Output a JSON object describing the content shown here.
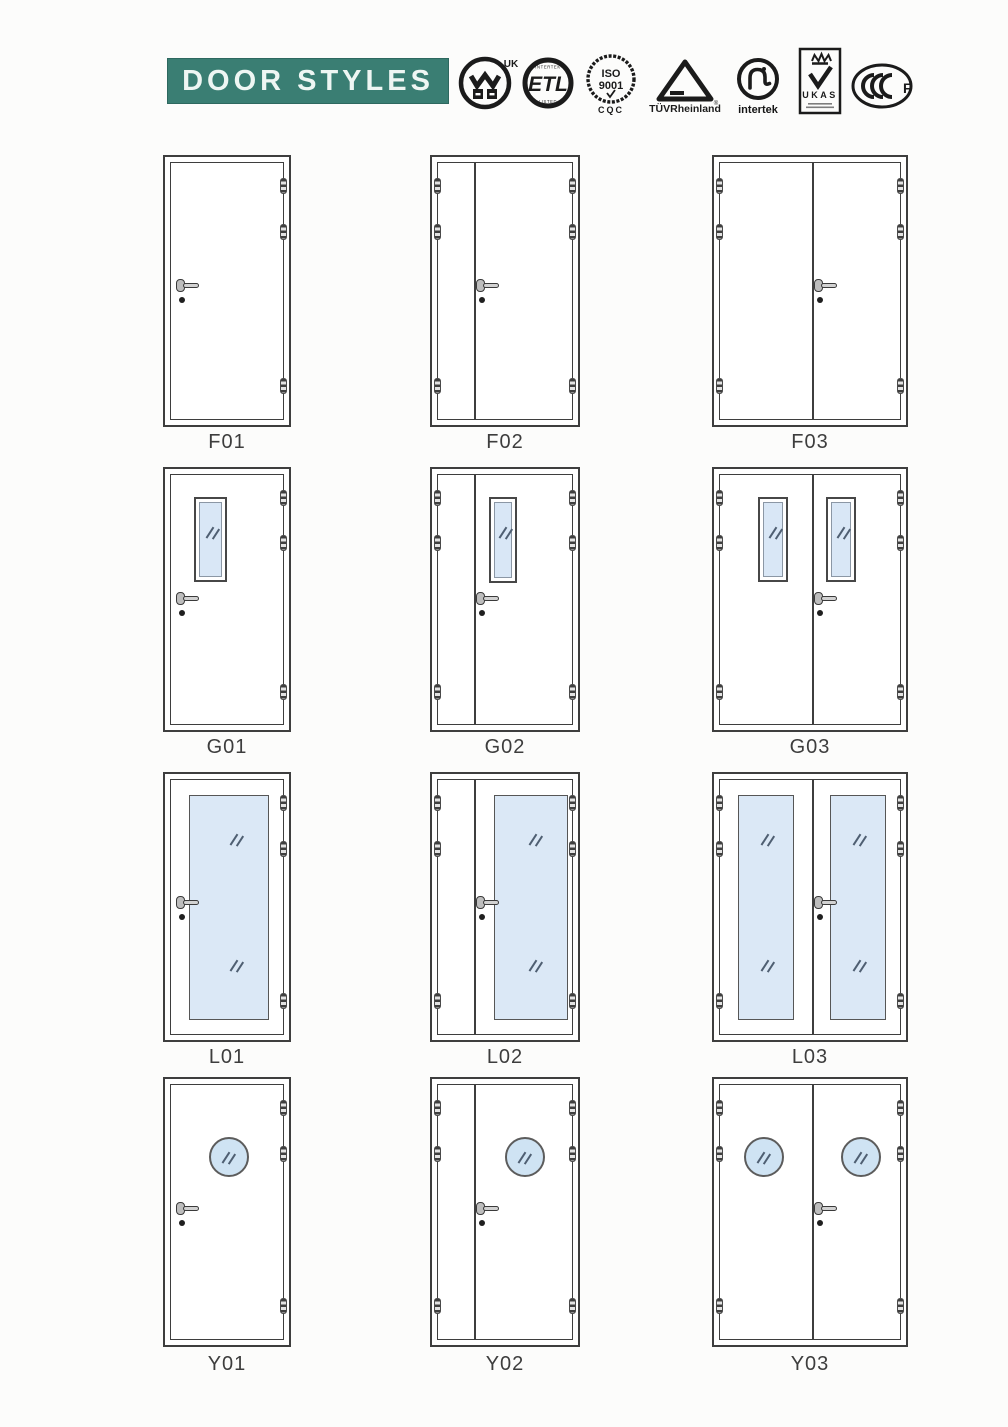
{
  "header": {
    "title": "DOOR STYLES",
    "banner_color": "#3A7E73"
  },
  "certifications": {
    "warrington": {
      "uk": "UK"
    },
    "etl": {
      "top": "INTERTEK",
      "main": "ETL",
      "bottom": "LISTED"
    },
    "iso": {
      "line1": "ISO",
      "line2": "9001",
      "footer": "CQC"
    },
    "tuv": {
      "label": "TÜVRheinland",
      "reg": "®"
    },
    "intertek": {
      "label": "intertek"
    },
    "ukas": {
      "label": "UKAS"
    },
    "cccf": {
      "letter": "F"
    }
  },
  "doors": [
    {
      "label": "F01",
      "style": "single flush door"
    },
    {
      "label": "F02",
      "style": "unequal double flush door"
    },
    {
      "label": "F03",
      "style": "equal double flush door"
    },
    {
      "label": "G01",
      "style": "single door with vision panel"
    },
    {
      "label": "G02",
      "style": "unequal double door with vision panel"
    },
    {
      "label": "G03",
      "style": "equal double door with vision panels"
    },
    {
      "label": "L01",
      "style": "single door with full glass panel"
    },
    {
      "label": "L02",
      "style": "unequal double door with full glass panel"
    },
    {
      "label": "L03",
      "style": "equal double door with full glass panels"
    },
    {
      "label": "Y01",
      "style": "single door with porthole window"
    },
    {
      "label": "Y02",
      "style": "unequal double door with porthole window"
    },
    {
      "label": "Y03",
      "style": "equal double door with porthole windows"
    }
  ],
  "colors": {
    "glass": "#DBE8F6",
    "porthole_glass": "#CFE3F3",
    "line": "#3E3E3E",
    "label": "#3D3D3D"
  }
}
